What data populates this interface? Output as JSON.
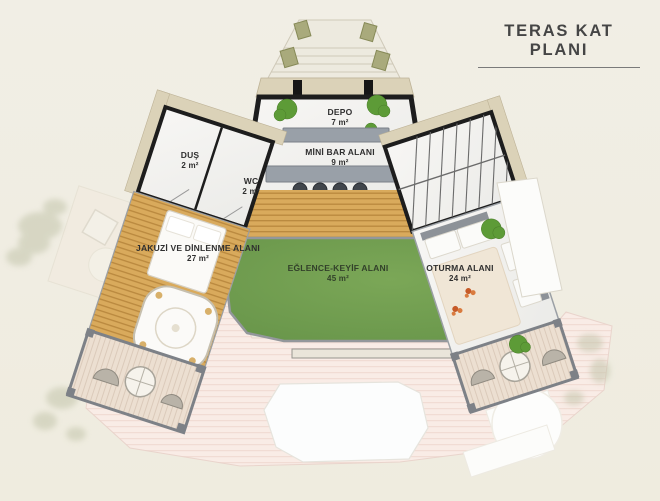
{
  "title": "TERAS KAT PLANI",
  "rooms": {
    "depo": {
      "name": "DEPO",
      "area": "7 m²"
    },
    "minibar": {
      "name": "MİNİ BAR ALANI",
      "area": "9 m²"
    },
    "dus": {
      "name": "DUŞ",
      "area": "2 m²"
    },
    "wc": {
      "name": "WC",
      "area": "2 m²"
    },
    "jakuzi": {
      "name": "JAKUZİ VE DİNLENME ALANI",
      "area": "27 m²"
    },
    "eglence": {
      "name": "EĞLENCE-KEYİF ALANI",
      "area": "45 m²"
    },
    "oturma": {
      "name": "OTURMA ALANI",
      "area": "24 m²"
    }
  },
  "colors": {
    "background": "#f0ede3",
    "grass": "#6f9d4a",
    "wood_deck": "#d9aa5c",
    "wall": "#1d1d1d",
    "marble": "#f4f3f1",
    "terrace_pink": "#f9ece6",
    "counter_gray": "#99a0a8",
    "bush_green": "#5d9b37",
    "tan_band": "#dbd2b8",
    "title_text": "#454545"
  }
}
